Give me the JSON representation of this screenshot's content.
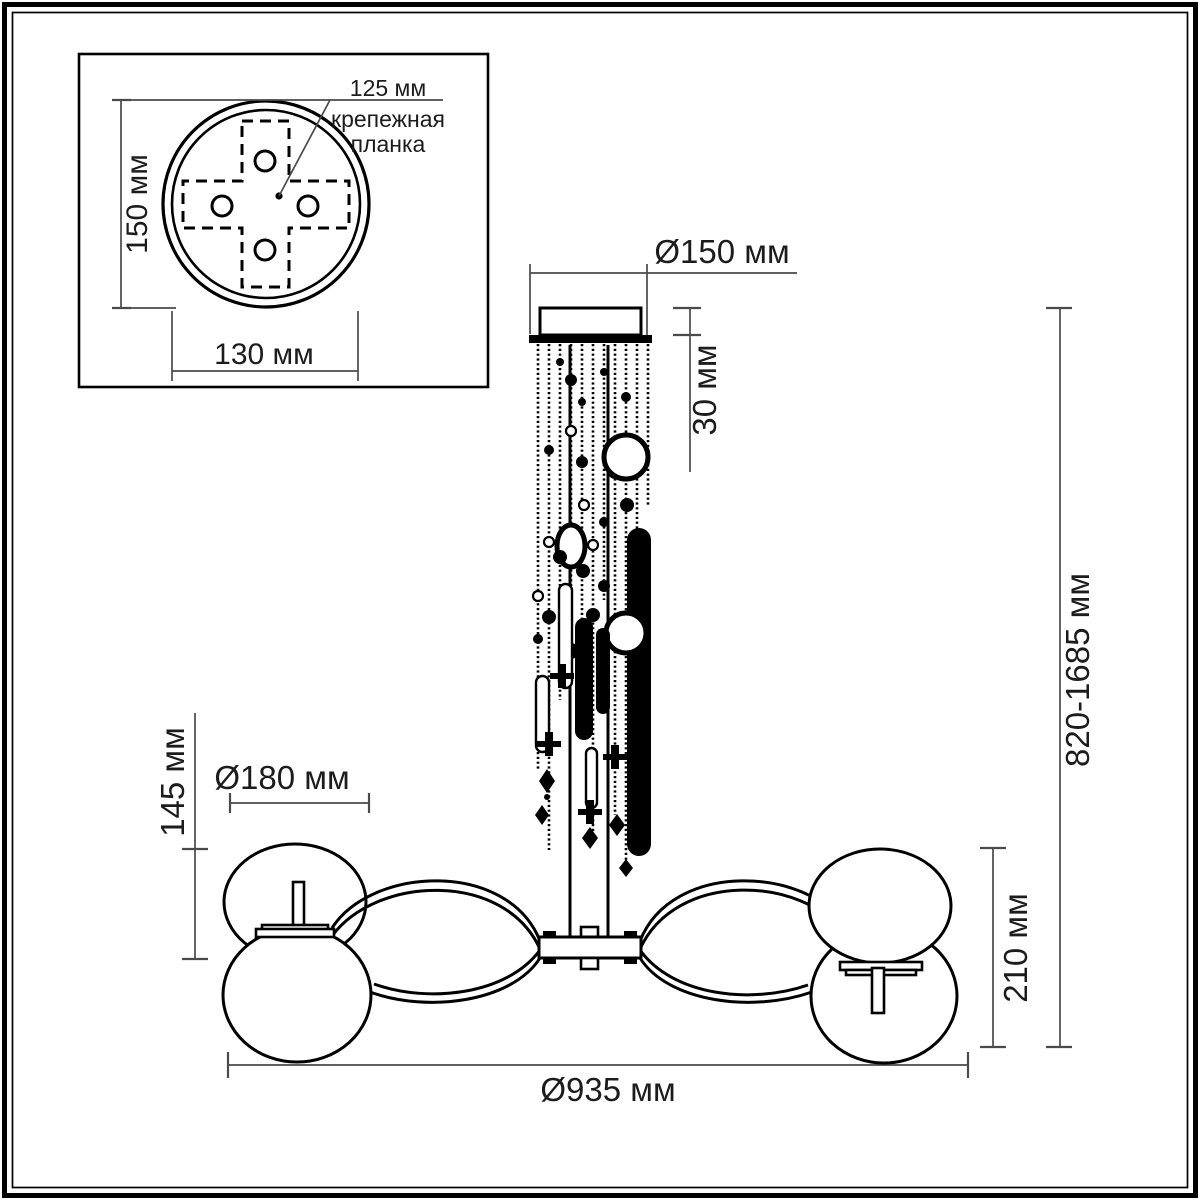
{
  "inset": {
    "hole_pitch_label": "125 мм",
    "plate_name_line1": "крепежная",
    "plate_name_line2": "планка",
    "plate_height_label": "150 мм",
    "plate_width_label": "130 мм"
  },
  "dimensions": {
    "canopy_diameter": "Ø150 мм",
    "canopy_height": "30 мм",
    "suspension_height": "820-1685 мм",
    "shade_diameter": "Ø180 мм",
    "shade_height": "145 мм",
    "body_height": "210 мм",
    "overall_diameter": "Ø935 мм"
  }
}
